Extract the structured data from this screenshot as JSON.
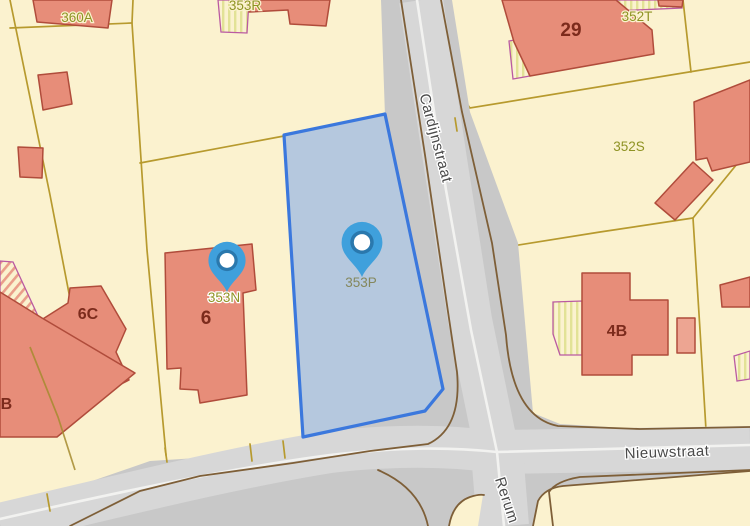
{
  "map": {
    "type": "cadastral-parcel-map",
    "selected_parcel": {
      "id": "353P"
    },
    "pins": [
      {
        "name": "pin-353P",
        "parcel": "353P"
      },
      {
        "name": "pin-353N",
        "parcel": "353N"
      }
    ],
    "parcel_labels": [
      {
        "text": "360A"
      },
      {
        "text": "353R"
      },
      {
        "text": "352T"
      },
      {
        "text": "352S"
      },
      {
        "text": "353N"
      },
      {
        "text": "353P"
      }
    ],
    "house_numbers": [
      {
        "text": "29"
      },
      {
        "text": "6"
      },
      {
        "text": "6C"
      },
      {
        "text": "6B"
      },
      {
        "text": "4B"
      }
    ],
    "street_names": [
      {
        "text": "Cardijnstraat"
      },
      {
        "text": "Nieuwstraat"
      },
      {
        "text": "Rerum"
      }
    ],
    "colors": {
      "background": "#FBF2CF",
      "parcel_line": "#B79A2E",
      "road_fill": "#C8C8C8",
      "carriageway": "#D7D7D7",
      "road_edge": "#7E5F38",
      "lane_line": "#F2F2F0",
      "building_fill": "#E78D79",
      "building_stroke": "#B04C3B",
      "building_light": "#EDA592",
      "hatch_stroke": "#BA5AA2",
      "hatch_stripe": "#E2E296",
      "selected_parcel_fill": "#B5C8DE",
      "selected_parcel_stroke": "#3B78DD",
      "pin_body": "#3FA0DC",
      "pin_ring": "#2A78AD",
      "parcel_label_text": "#8F9324",
      "house_number_text": "#7C2B1C",
      "street_label_text": "#4A4A4A"
    }
  }
}
